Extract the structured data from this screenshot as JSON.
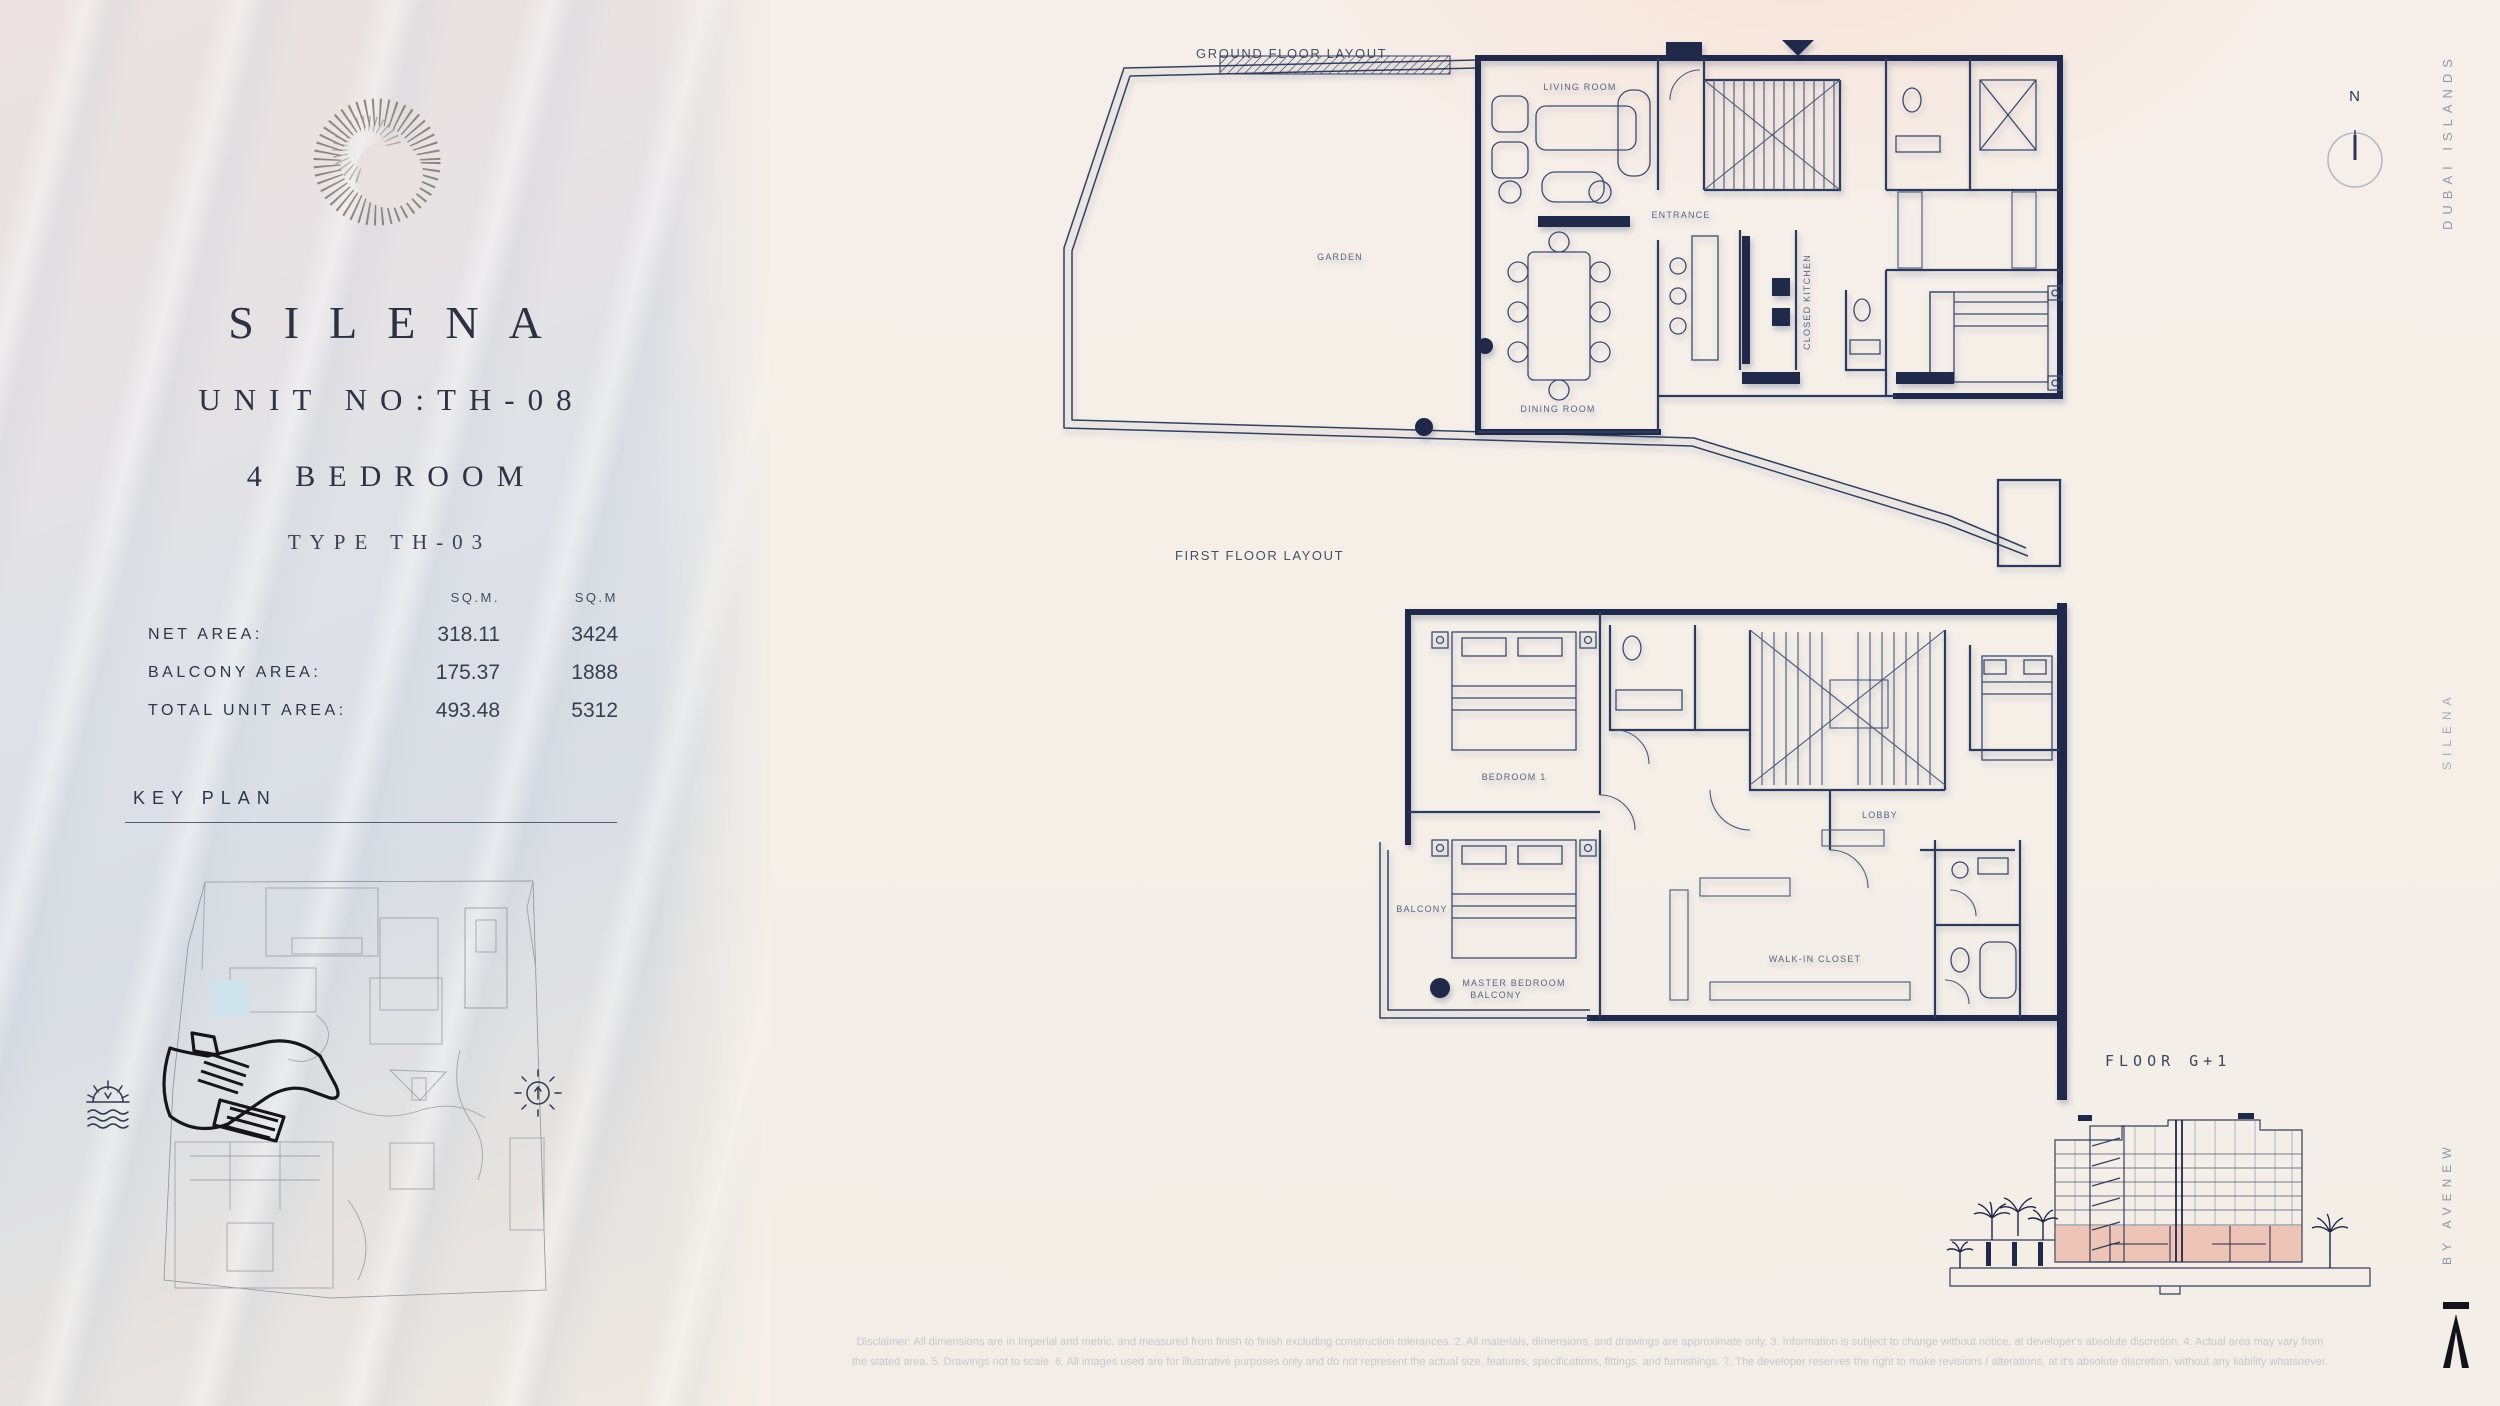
{
  "palette": {
    "wall_navy": "#20294a",
    "line_navy": "#3e4b6e",
    "elevation_pink": "#eec4b6",
    "pool_blue": "#cfe3ec",
    "text_dark": "#2a3142",
    "muted_gray": "#9aa0a6"
  },
  "left_panel": {
    "logo": "spiral-shell-logo",
    "title": "SILENA",
    "unit_no": "UNIT NO:TH-08",
    "bedrooms": "4 BEDROOM",
    "type_label": "TYPE TH-03",
    "table": {
      "col1_header": "SQ.M.",
      "col2_header": "SQ.M",
      "rows": [
        {
          "label": "NET AREA:",
          "sqm": "318.11",
          "sqft": "3424"
        },
        {
          "label": "BALCONY AREA:",
          "sqm": "175.37",
          "sqft": "1888"
        },
        {
          "label": "TOTAL UNIT AREA:",
          "sqm": "493.48",
          "sqft": "5312"
        }
      ]
    },
    "key_plan_title": "KEY PLAN"
  },
  "plans": {
    "ground_label": "GROUND FLOOR LAYOUT",
    "first_label": "FIRST FLOOR LAYOUT",
    "ground_rooms": {
      "living": "LIVING ROOM",
      "dining": "DINING ROOM",
      "garden": "GARDEN",
      "kitchen": "CLOSED KITCHEN",
      "entrance": "ENTRANCE"
    },
    "first_rooms": {
      "bed1": "BEDROOM 1",
      "master": "MASTER BEDROOM",
      "closet": "WALK-IN CLOSET",
      "lobby": "LOBBY",
      "balcony1": "BALCONY",
      "balcony2": "BALCONY"
    }
  },
  "elevation_label": "FLOOR G+1",
  "compass_label": "N",
  "right_rail": {
    "top": "DUBAI ISLANDS",
    "middle": "SILENA",
    "bottom": "BY AVENEW"
  },
  "disclaimer": {
    "line1": "Disclaimer: All dimensions are in Imperial and metric, and measured from finish to finish excluding construction tolerances. 2. All materials, dimensions, and drawings are approximate only. 3. Information is subject to change without notice, at developer's absolute discretion. 4. Actual area may vary from",
    "line2": "the stated area. 5. Drawings not to scale. 6. All images used are for illustrative purposes only and do not represent the actual size, features, specifications, fittings, and furnishings. 7. The developer reserves the right to make revisions / alterations, at it's absolute discretion, without any liability whatsoever."
  }
}
